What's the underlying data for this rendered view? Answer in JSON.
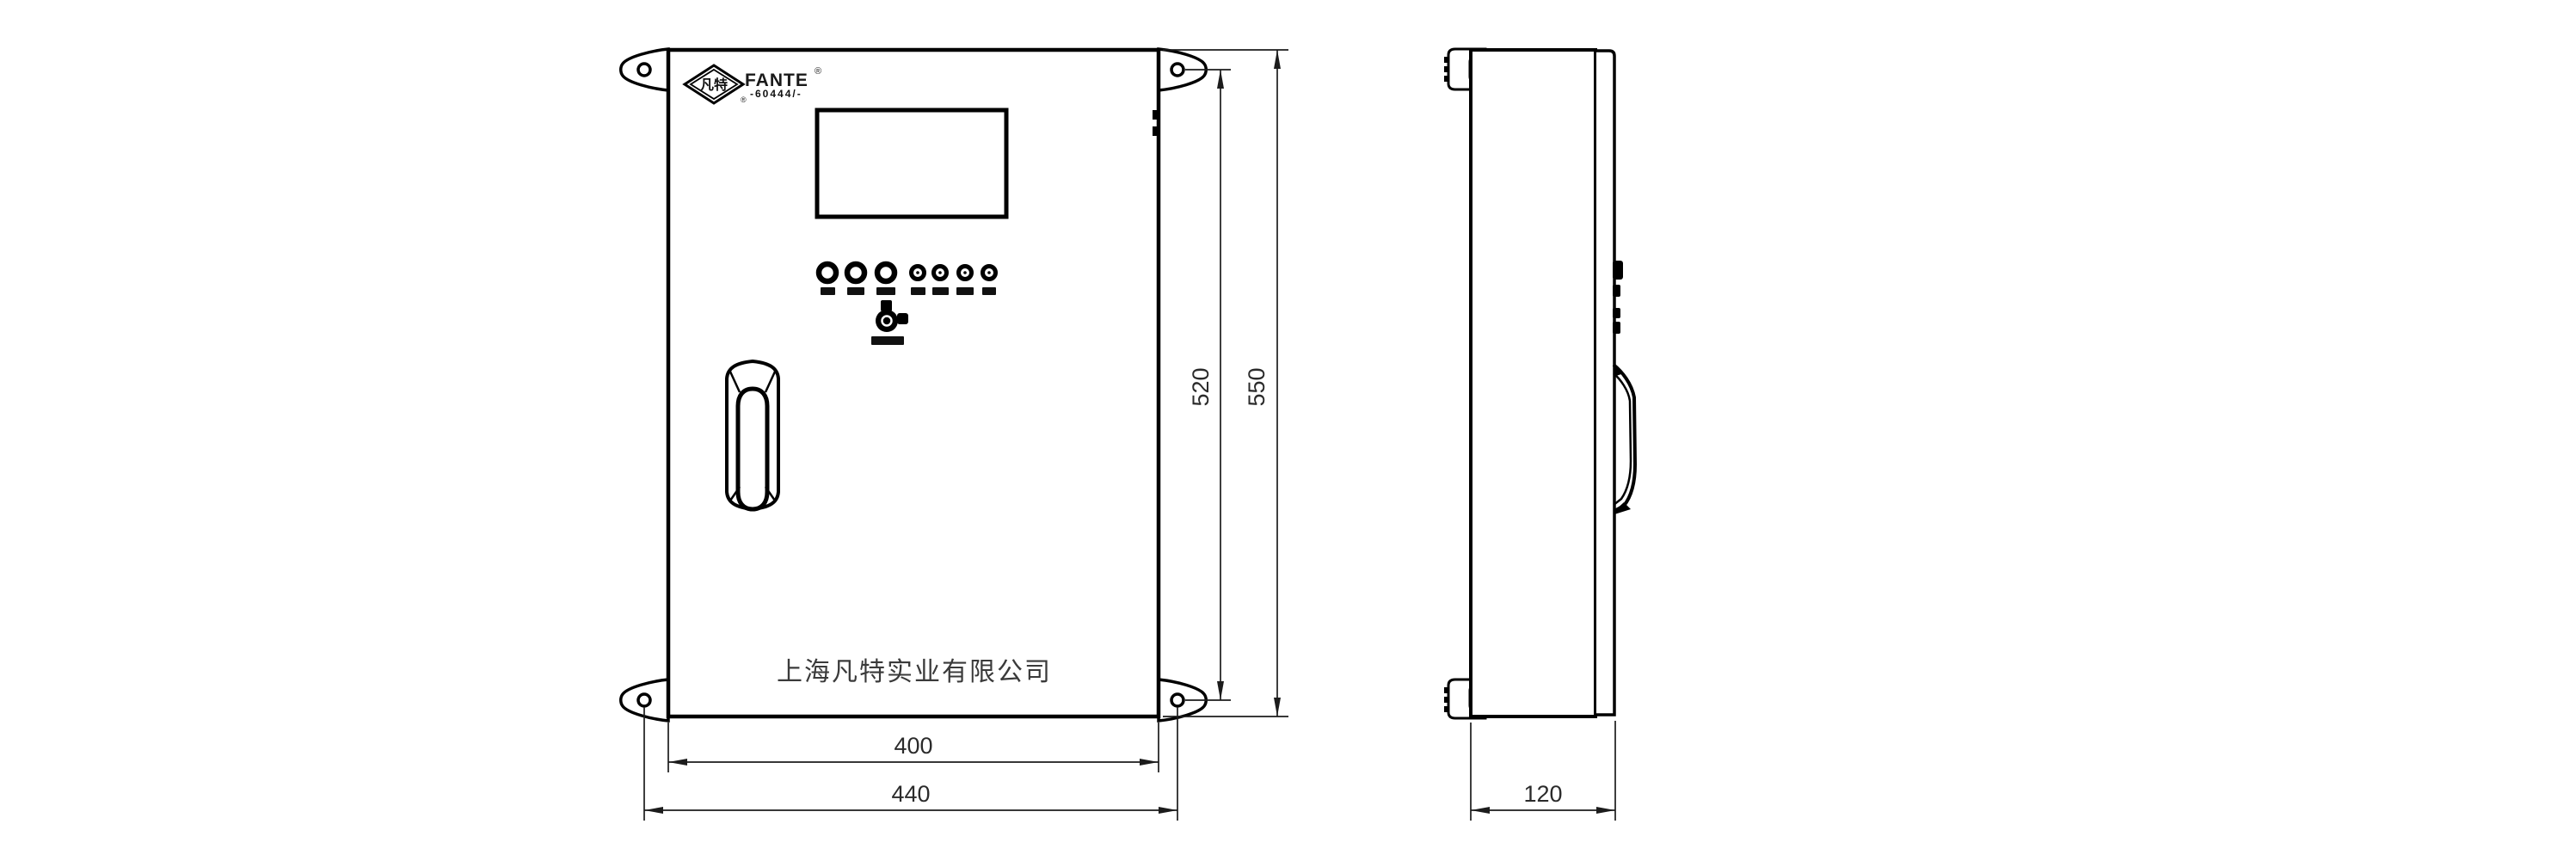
{
  "drawing": {
    "type": "technical-dimension-drawing",
    "logo": {
      "diamond_text": "凡特",
      "brand": "FANTE",
      "registered": "®",
      "registered_small": "®",
      "tagline_illegible": "-60444/-"
    },
    "front_view": {
      "company_name": "上海凡特实业有限公司"
    },
    "dimensions": {
      "inner_height": "520",
      "outer_height": "550",
      "inner_width": "400",
      "outer_width": "440",
      "depth": "120"
    },
    "colors": {
      "line": "#000000",
      "dimension_line": "#1c1c1c",
      "text": "#2b2b2b",
      "background": "#ffffff"
    }
  }
}
